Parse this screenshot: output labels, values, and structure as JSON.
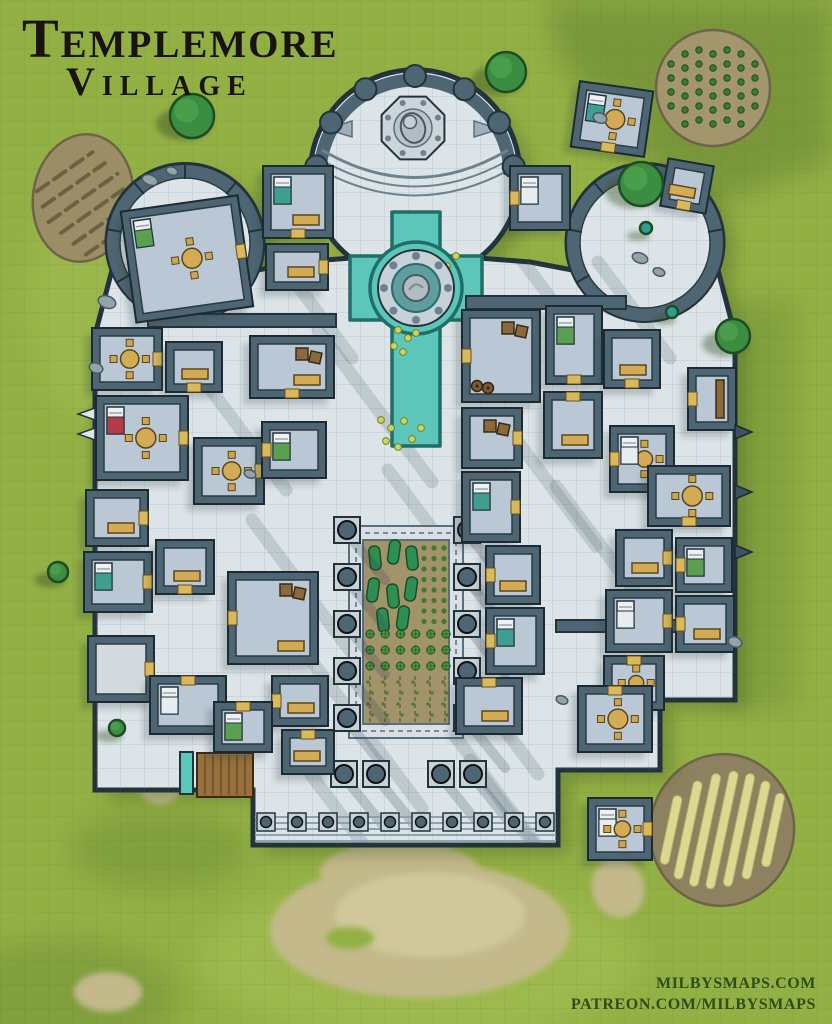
{
  "title": {
    "line1": "Templemore",
    "line2": "Village"
  },
  "attribution": {
    "line1": "MILBYSMAPS.COM",
    "line2": "PATREON.COM/MILBYSMAPS"
  },
  "palette": {
    "grass": "#93b045",
    "grass_light": "#a8c257",
    "grass_dark": "#5a7a2e",
    "stone": "#dce4e8",
    "stone_grid": "#8fa5b2",
    "wall": "#4e6673",
    "wall_dark": "#22333c",
    "floor": "#b9c8d4",
    "floor_plain": "#d3dade",
    "soil": "#9b8d66",
    "soil_edge": "#6f6448",
    "soil2": "#a3956c",
    "soil3": "#8d815f",
    "dirt": "#c3b98b",
    "dirt_light": "#d0c79b",
    "water": "#5cc6ba",
    "water_edge": "#1f6f68",
    "tree": "#3b8d41",
    "tree_hi": "#4fa24d",
    "tree_edge": "#1d4d22",
    "plant": "#3c7a33",
    "hay": "#dcd892",
    "tan": "#d2ab54",
    "tan_edge": "#5c4518",
    "wood": "#96713d",
    "wood_dark": "#6b4e25",
    "crate": "#8a6a3c",
    "bed_base": "#eef0f2",
    "bed_white": "#e8ecef",
    "bed_teal": "#3f9e8f",
    "bed_green": "#5aa050",
    "bed_red": "#b23b47",
    "ring": "#c8d1d8",
    "statue": "#b2bcc4",
    "bolt": "#6d828f",
    "rock": "#93a3ab"
  },
  "map": {
    "grid_size": 24,
    "silhouette": "M95,790 L95,335 L112,270 A78,78 0 1 1 258,270 L300,262 L351,258 A105,105 0 1 1 479,258 L530,262 L572,270 A78,78 0 1 1 718,270 L735,335 L735,700 L660,700 L660,770 L558,770 L558,845 L253,845 L253,790 Z",
    "apse": {
      "cx": 415,
      "cy": 175,
      "r": 99,
      "column_angles": [
        185,
        212,
        240,
        270,
        300,
        328,
        355
      ],
      "statue": {
        "cx": 413,
        "cy": 128,
        "r": 34
      }
    },
    "lobes": [
      {
        "cx": 185,
        "cy": 243,
        "r": 72
      },
      {
        "cx": 645,
        "cy": 243,
        "r": 72
      }
    ],
    "pool": {
      "path": "M392,212 h48 v44 h42 v64 h-42 v126 h-48 v-126 h-42 v-64 h42 Z",
      "bulge": {
        "cx": 416,
        "cy": 288,
        "r": 46
      },
      "ring": {
        "outer": 38,
        "inner": 24,
        "statue": 13
      },
      "lilies": [
        [
          447,
          266
        ],
        [
          456,
          256
        ],
        [
          438,
          277
        ],
        [
          450,
          280
        ],
        [
          429,
          270
        ],
        [
          398,
          330
        ],
        [
          408,
          338
        ],
        [
          394,
          346
        ],
        [
          416,
          333
        ],
        [
          403,
          352
        ],
        [
          381,
          420
        ],
        [
          391,
          428
        ],
        [
          404,
          421
        ],
        [
          386,
          441
        ],
        [
          398,
          447
        ],
        [
          412,
          439
        ],
        [
          421,
          428
        ]
      ]
    },
    "garden": {
      "x": 349,
      "y": 526,
      "w": 114,
      "h": 212,
      "inset": 14,
      "blobs": [
        [
          375,
          558
        ],
        [
          394,
          552
        ],
        [
          412,
          558
        ],
        [
          373,
          590
        ],
        [
          393,
          596
        ],
        [
          411,
          589
        ],
        [
          383,
          620
        ],
        [
          403,
          618
        ]
      ],
      "dot_cols": [
        424,
        434,
        444
      ],
      "dot_rows_y0": 548,
      "dot_rows_n": 8,
      "dot_step": 10.5,
      "star_x0": 370,
      "star_nx": 6,
      "star_sx": 15.2,
      "star_y0": 634,
      "star_ny": 3,
      "star_sy": 16,
      "furrow_x": [
        370,
        385,
        400,
        415,
        430,
        445
      ],
      "furrow_y0": 676,
      "furrow_y1": 722
    },
    "colonnade": {
      "left_x": 347,
      "right_x": 467,
      "ys": [
        530,
        577,
        624,
        671,
        718
      ],
      "portico": [
        [
          344,
          774
        ],
        [
          376,
          774
        ],
        [
          441,
          774
        ],
        [
          473,
          774
        ]
      ]
    },
    "front_steps": {
      "x1": 255,
      "x2": 556,
      "ys": [
        817,
        823,
        829,
        835,
        841
      ],
      "base_y": 822,
      "base_xs": [
        266,
        297,
        328,
        359,
        390,
        421,
        452,
        483,
        514,
        545
      ]
    },
    "wooden_steps": {
      "x": 197,
      "y": 753,
      "w": 56,
      "h": 44
    },
    "trough": {
      "x": 180,
      "y": 752,
      "w": 13,
      "h": 42
    },
    "fields": [
      {
        "name": "field-furrows",
        "cx": 83,
        "cy": 198,
        "rx": 50,
        "ry": 64,
        "rot": 8,
        "type": "furrows"
      },
      {
        "name": "field-crops",
        "cx": 713,
        "cy": 88,
        "rx": 57,
        "ry": 58,
        "rot": 0,
        "type": "crops"
      },
      {
        "name": "field-hay",
        "cx": 722,
        "cy": 830,
        "rx": 72,
        "ry": 76,
        "rot": 10,
        "type": "hay"
      }
    ],
    "dirt_patches": [
      {
        "cx": 420,
        "cy": 930,
        "rx": 150,
        "ry": 68,
        "rot": 0
      },
      {
        "cx": 400,
        "cy": 872,
        "rx": 80,
        "ry": 30,
        "rot": 0
      },
      {
        "cx": 618,
        "cy": 888,
        "rx": 26,
        "ry": 30,
        "rot": -15
      },
      {
        "cx": 160,
        "cy": 790,
        "rx": 20,
        "ry": 14,
        "rot": 0
      },
      {
        "cx": 108,
        "cy": 992,
        "rx": 34,
        "ry": 20,
        "rot": 0
      }
    ],
    "trees": [
      {
        "x": 192,
        "y": 116,
        "r": 22
      },
      {
        "x": 506,
        "y": 72,
        "r": 20
      },
      {
        "x": 641,
        "y": 184,
        "r": 22
      },
      {
        "x": 733,
        "y": 336,
        "r": 17
      },
      {
        "x": 58,
        "y": 572,
        "r": 10
      },
      {
        "x": 117,
        "y": 728,
        "r": 8
      },
      {
        "x": 646,
        "y": 228,
        "r": 6,
        "teal": true
      },
      {
        "x": 672,
        "y": 312,
        "r": 6,
        "teal": true
      }
    ],
    "rooms": [
      {
        "x": 128,
        "y": 203,
        "w": 118,
        "h": 112,
        "rot": -8,
        "f": [
          "t",
          "bg"
        ],
        "d": "e"
      },
      {
        "x": 263,
        "y": 166,
        "w": 70,
        "h": 72,
        "rot": 0,
        "f": [
          "bt",
          "r"
        ],
        "d": "s"
      },
      {
        "x": 266,
        "y": 244,
        "w": 62,
        "h": 46,
        "rot": 0,
        "f": [
          "r"
        ],
        "d": "e"
      },
      {
        "x": 510,
        "y": 166,
        "w": 60,
        "h": 64,
        "rot": 0,
        "f": [
          "bw"
        ],
        "d": "w"
      },
      {
        "x": 575,
        "y": 86,
        "w": 74,
        "h": 66,
        "rot": 8,
        "f": [
          "bt",
          "t"
        ],
        "d": "s"
      },
      {
        "x": 664,
        "y": 162,
        "w": 46,
        "h": 48,
        "rot": 10,
        "f": [
          "r"
        ],
        "d": "s"
      },
      {
        "x": 92,
        "y": 328,
        "w": 70,
        "h": 62,
        "rot": 0,
        "f": [
          "t"
        ],
        "d": "e"
      },
      {
        "x": 166,
        "y": 342,
        "w": 56,
        "h": 50,
        "rot": 0,
        "f": [
          "r"
        ],
        "d": "s"
      },
      {
        "x": 250,
        "y": 336,
        "w": 84,
        "h": 62,
        "rot": 0,
        "f": [
          "r",
          "c"
        ],
        "d": "s"
      },
      {
        "x": 96,
        "y": 396,
        "w": 92,
        "h": 84,
        "rot": 0,
        "f": [
          "br",
          "t"
        ],
        "d": "e"
      },
      {
        "x": 194,
        "y": 438,
        "w": 70,
        "h": 66,
        "rot": 0,
        "f": [
          "t"
        ],
        "d": "e"
      },
      {
        "x": 262,
        "y": 422,
        "w": 64,
        "h": 56,
        "rot": 0,
        "f": [
          "bg"
        ],
        "d": "w"
      },
      {
        "x": 86,
        "y": 490,
        "w": 62,
        "h": 56,
        "rot": 0,
        "f": [
          "r"
        ],
        "d": "e"
      },
      {
        "x": 84,
        "y": 552,
        "w": 68,
        "h": 60,
        "rot": 0,
        "f": [
          "bt"
        ],
        "d": "e"
      },
      {
        "x": 156,
        "y": 540,
        "w": 58,
        "h": 54,
        "rot": 0,
        "f": [
          "r"
        ],
        "d": "s"
      },
      {
        "x": 228,
        "y": 572,
        "w": 90,
        "h": 92,
        "rot": 0,
        "f": [
          "r",
          "c"
        ],
        "d": "w"
      },
      {
        "x": 88,
        "y": 636,
        "w": 66,
        "h": 66,
        "rot": 0,
        "f": [],
        "plain": true,
        "d": "e"
      },
      {
        "x": 150,
        "y": 676,
        "w": 76,
        "h": 58,
        "rot": 0,
        "f": [
          "bw"
        ],
        "d": "n"
      },
      {
        "x": 272,
        "y": 676,
        "w": 56,
        "h": 50,
        "rot": 0,
        "f": [
          "r"
        ],
        "d": "w"
      },
      {
        "x": 214,
        "y": 702,
        "w": 58,
        "h": 50,
        "rot": 0,
        "f": [
          "bg"
        ],
        "d": "n"
      },
      {
        "x": 282,
        "y": 730,
        "w": 52,
        "h": 44,
        "rot": 0,
        "f": [
          "r"
        ],
        "d": "n"
      },
      {
        "x": 462,
        "y": 310,
        "w": 78,
        "h": 92,
        "rot": 0,
        "f": [
          "c",
          "k"
        ],
        "d": "w"
      },
      {
        "x": 546,
        "y": 306,
        "w": 56,
        "h": 78,
        "rot": 0,
        "f": [
          "bg"
        ],
        "d": "s"
      },
      {
        "x": 604,
        "y": 330,
        "w": 56,
        "h": 58,
        "rot": 0,
        "f": [
          "r"
        ],
        "d": "s"
      },
      {
        "x": 688,
        "y": 368,
        "w": 48,
        "h": 62,
        "rot": 0,
        "f": [
          "s"
        ],
        "d": "w"
      },
      {
        "x": 610,
        "y": 426,
        "w": 64,
        "h": 66,
        "rot": 0,
        "f": [
          "t",
          "bw"
        ],
        "d": "w"
      },
      {
        "x": 544,
        "y": 392,
        "w": 58,
        "h": 66,
        "rot": 0,
        "f": [
          "r"
        ],
        "d": "n"
      },
      {
        "x": 462,
        "y": 408,
        "w": 60,
        "h": 60,
        "rot": 0,
        "f": [
          "c"
        ],
        "d": "e"
      },
      {
        "x": 462,
        "y": 472,
        "w": 58,
        "h": 70,
        "rot": 0,
        "f": [
          "bt"
        ],
        "d": "e"
      },
      {
        "x": 648,
        "y": 466,
        "w": 82,
        "h": 60,
        "rot": 0,
        "f": [
          "t"
        ],
        "d": "s"
      },
      {
        "x": 616,
        "y": 530,
        "w": 56,
        "h": 56,
        "rot": 0,
        "f": [
          "r"
        ],
        "d": "e"
      },
      {
        "x": 676,
        "y": 538,
        "w": 56,
        "h": 54,
        "rot": 0,
        "f": [
          "bg"
        ],
        "d": "w"
      },
      {
        "x": 606,
        "y": 590,
        "w": 66,
        "h": 62,
        "rot": 0,
        "f": [
          "bw"
        ],
        "d": "e"
      },
      {
        "x": 676,
        "y": 596,
        "w": 58,
        "h": 56,
        "rot": 0,
        "f": [
          "r"
        ],
        "d": "w"
      },
      {
        "x": 604,
        "y": 656,
        "w": 60,
        "h": 54,
        "rot": 0,
        "f": [
          "t"
        ],
        "d": "n"
      },
      {
        "x": 486,
        "y": 546,
        "w": 54,
        "h": 58,
        "rot": 0,
        "f": [
          "r"
        ],
        "d": "w"
      },
      {
        "x": 486,
        "y": 608,
        "w": 58,
        "h": 66,
        "rot": 0,
        "f": [
          "bt"
        ],
        "d": "w"
      },
      {
        "x": 456,
        "y": 678,
        "w": 66,
        "h": 56,
        "rot": 0,
        "f": [
          "r"
        ],
        "d": "n"
      },
      {
        "x": 578,
        "y": 686,
        "w": 74,
        "h": 66,
        "rot": 0,
        "f": [
          "t"
        ],
        "d": "n"
      },
      {
        "x": 588,
        "y": 798,
        "w": 64,
        "h": 62,
        "rot": 0,
        "f": [
          "bw",
          "t"
        ],
        "d": "e"
      }
    ],
    "connectors": [
      {
        "x": 148,
        "y": 314,
        "w": 188,
        "h": 13
      },
      {
        "x": 466,
        "y": 296,
        "w": 160,
        "h": 13
      },
      {
        "x": 556,
        "y": 620,
        "w": 178,
        "h": 12
      }
    ],
    "shadow_bands": [
      [
        262,
        238,
        150
      ],
      [
        318,
        330,
        190
      ],
      [
        252,
        520,
        170
      ],
      [
        388,
        470,
        150
      ],
      [
        296,
        640,
        210
      ],
      [
        424,
        622,
        190
      ],
      [
        500,
        418,
        160
      ],
      [
        516,
        252,
        130
      ],
      [
        428,
        700,
        180
      ],
      [
        556,
        486,
        150
      ],
      [
        598,
        262,
        120
      ],
      [
        208,
        386,
        130
      ],
      [
        300,
        760,
        170
      ],
      [
        470,
        760,
        160
      ]
    ],
    "pebbles": [
      [
        150,
        180,
        8,
        5
      ],
      [
        172,
        171,
        6,
        4
      ],
      [
        107,
        302,
        9,
        6
      ],
      [
        96,
        368,
        7,
        5
      ],
      [
        640,
        258,
        8,
        5
      ],
      [
        659,
        272,
        6,
        4
      ],
      [
        735,
        642,
        7,
        5
      ],
      [
        562,
        700,
        6,
        4
      ],
      [
        600,
        118,
        7,
        5
      ],
      [
        250,
        474,
        6,
        4
      ]
    ],
    "buttresses_left": [
      414,
      434
    ],
    "buttresses_right": [
      432,
      492,
      552
    ]
  }
}
